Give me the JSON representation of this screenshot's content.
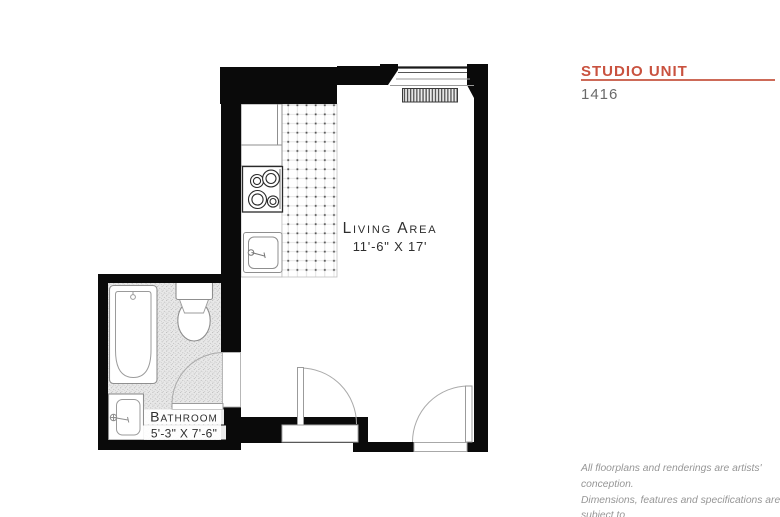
{
  "panel": {
    "title": "STUDIO UNIT",
    "unit_number": "1416",
    "accent_color": "#c9523f",
    "disclaimer": {
      "line1": "All floorplans and renderings are artists' conception.",
      "line2": "Dimensions, features and specifications are subject to",
      "line3": "change at the discretion of the builder."
    }
  },
  "floorplan": {
    "living_area": {
      "label": "Living Area",
      "dimensions": "11'-6\" X 17'"
    },
    "bathroom": {
      "label": "Bathroom",
      "dimensions": "5'-3\" X 7'-6\""
    },
    "fixtures": [
      "window",
      "radiator",
      "kitchen-cabinet",
      "stove",
      "kitchen-sink",
      "bathtub",
      "toilet",
      "bathroom-sink",
      "bathroom-door",
      "interior-door",
      "entry-door"
    ],
    "colors": {
      "wall": "#0a0a0a",
      "fixture_outline": "#8f8f8f",
      "bathroom_floor": "#e8e8e8"
    }
  }
}
